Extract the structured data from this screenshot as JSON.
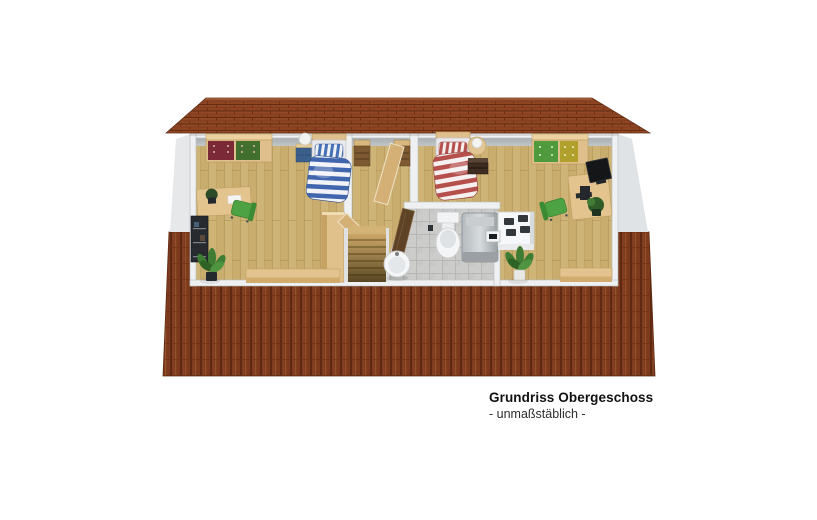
{
  "caption": {
    "title": "Grundriss Obergeschoss",
    "subtitle": "- unmaßstäblich -"
  },
  "scene": {
    "type": "3d-floorplan-cutaway-render",
    "view": "upper floor (attic) seen from front-above, roof slopes above and below the cutaway",
    "rooms": [
      {
        "id": "bedroom-left",
        "floor_material": "light wood planks",
        "furniture": [
          "wardrobe with dark-red and dark-green drawer fronts",
          "single bed with blue-white striped duvet and pillow",
          "blue nightstand with white table lamp",
          "desk with dark plant and papers",
          "black book shelf",
          "green desk chair",
          "tall wooden cabinet",
          "low wooden sideboard",
          "potted floor plant"
        ]
      },
      {
        "id": "landing-stairwell",
        "floor_material": "light wood planks",
        "furniture": [
          "staircase leading down",
          "two open wooden doors",
          "two small wooden cabinets",
          "wooden balustrade panel"
        ]
      },
      {
        "id": "bathroom",
        "floor_material": "grey tiles",
        "furniture": [
          "toilet with cistern",
          "grey shower cabin",
          "round white washbasin",
          "small wall heater",
          "open dark wooden door",
          "white chimney shaft with four dark flues"
        ]
      },
      {
        "id": "bedroom-right",
        "floor_material": "light wood planks",
        "furniture": [
          "wardrobe with green and yellow drawer fronts",
          "single bed with red-white striped duvet and pillow",
          "round bedside table with white lamp",
          "dark brown nightstand",
          "desk with black monitor, tower and plant",
          "green desk chair",
          "low wooden sideboard",
          "potted floor plant"
        ]
      }
    ],
    "colors": {
      "roof_front": "#7d3a1d",
      "roof_top": "#8d4423",
      "wall_grey": "#c0c4c8",
      "wall_cap": "#eef0f1",
      "wood_floor": "#cfb478",
      "tile_floor": "#cccccb",
      "furniture_wood": "#e3c48e",
      "door_wood": "#d4b077",
      "bath_door_wood": "#5e4226",
      "wardrobe_red": "#7b2837",
      "wardrobe_green": "#41702e",
      "wardrobe_lime": "#4e9a3c",
      "wardrobe_yellow": "#b2a02c",
      "nightstand_blue": "#3a5f8a",
      "nightstand_dark": "#3e2c20",
      "bed_blue_stripe": "#4066ae",
      "bed_red_stripe": "#b5504c",
      "chair_green": "#4da343",
      "plant_green": "#3e7d33",
      "fixture_white": "#f4f5f6",
      "monitor_black": "#141618"
    }
  }
}
